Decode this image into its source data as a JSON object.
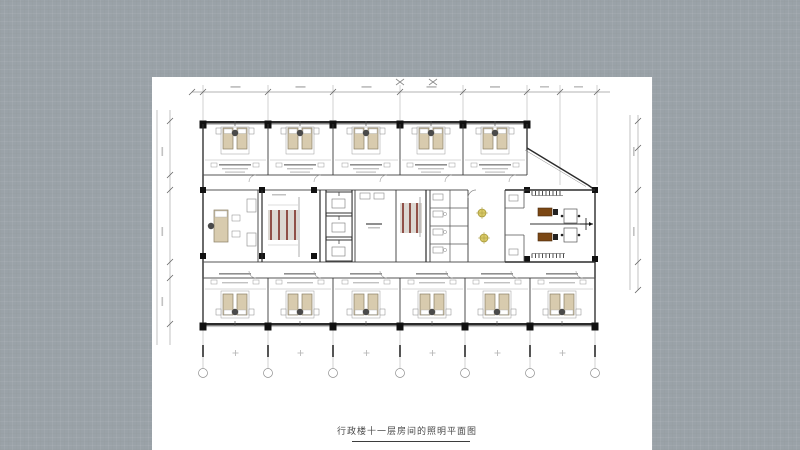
{
  "title_block": {
    "title": "行政楼十一层房间的照明平面图"
  },
  "plan": {
    "colors": {
      "wall": "#2b2b2b",
      "column": "#111111",
      "inner_wall": "#555555",
      "light_wall": "#9a9a9a",
      "dim": "#9a9a9a",
      "tick": "#666666",
      "text_dash": "#c2c2c2",
      "label_dash": "#8f8f8f",
      "bed_fill": "#d8cbae",
      "bed_stroke": "#8a7f66",
      "pillow": "#ffffff",
      "nightstand": "#4a4a4a",
      "stair_bg": "#dcd8d2",
      "stair_stripe": "#7e2f26",
      "desk": "#7b4714",
      "desk_stroke": "#4a2a0c",
      "chair": "#222222",
      "plant": "#d9c967",
      "plant_stroke": "#a89a3c"
    },
    "top_grid_x": [
      51,
      116,
      181,
      248,
      311,
      375
    ],
    "right_grid_x": [
      408,
      445
    ],
    "bottom_grid_x": [
      51,
      116,
      181,
      248,
      313,
      378,
      443
    ],
    "top_bed_x": [
      83,
      148,
      214,
      279,
      343
    ],
    "bottom_bed_x": [
      83,
      148,
      214,
      280,
      345,
      410
    ],
    "stair1_stripes_x": [
      119,
      127,
      135,
      143
    ],
    "stair2_stripes_x": [
      251,
      258,
      265
    ],
    "elevator_cells_y": [
      115,
      139,
      163
    ],
    "bath_rows_y": [
      131,
      149,
      167
    ],
    "plants": [
      [
        330,
        136
      ],
      [
        332,
        161
      ]
    ],
    "desks_y": [
      131,
      156
    ],
    "x_marks": [
      [
        248,
        5
      ],
      [
        281,
        5
      ]
    ]
  }
}
